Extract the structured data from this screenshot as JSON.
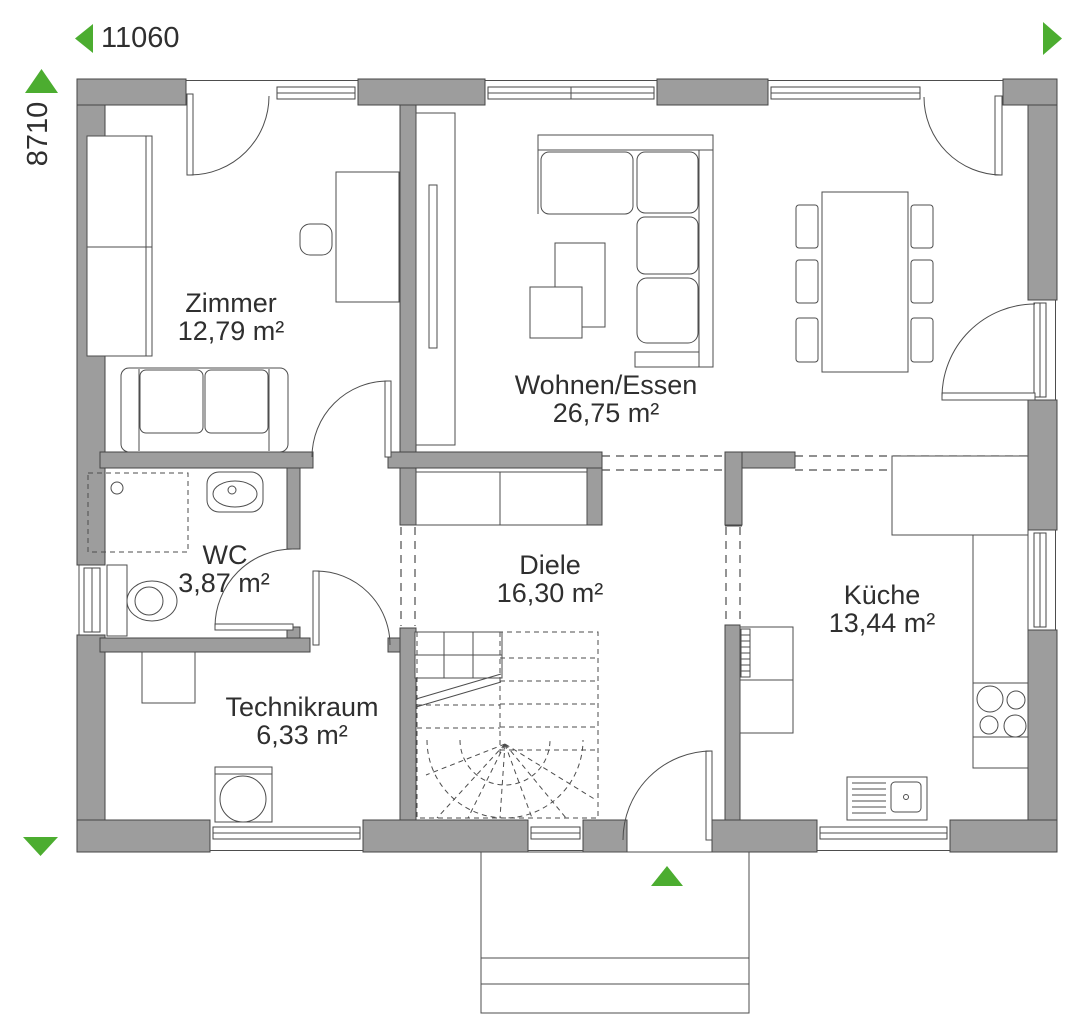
{
  "floor_plan": {
    "dimensions": {
      "width_mm": "11060",
      "height_mm": "8710"
    },
    "rooms": [
      {
        "name": "Zimmer",
        "area": "12,79 m²"
      },
      {
        "name": "Wohnen/Essen",
        "area": "26,75 m²"
      },
      {
        "name": "WC",
        "area": "3,87 m²"
      },
      {
        "name": "Diele",
        "area": "16,30 m²"
      },
      {
        "name": "Technikraum",
        "area": "6,33 m²"
      },
      {
        "name": "Küche",
        "area": "13,44 m²"
      }
    ],
    "colors": {
      "wall": "#9d9d9d",
      "line": "#454545",
      "accent_green": "#4cad30",
      "text": "#2f2f2f",
      "background": "#ffffff"
    },
    "icons": {
      "dimension_arrow_left": "left-triangle",
      "dimension_arrow_right": "right-triangle",
      "dimension_arrow_up": "up-triangle",
      "dimension_arrow_down": "down-triangle",
      "entrance_arrow": "up-triangle"
    }
  }
}
